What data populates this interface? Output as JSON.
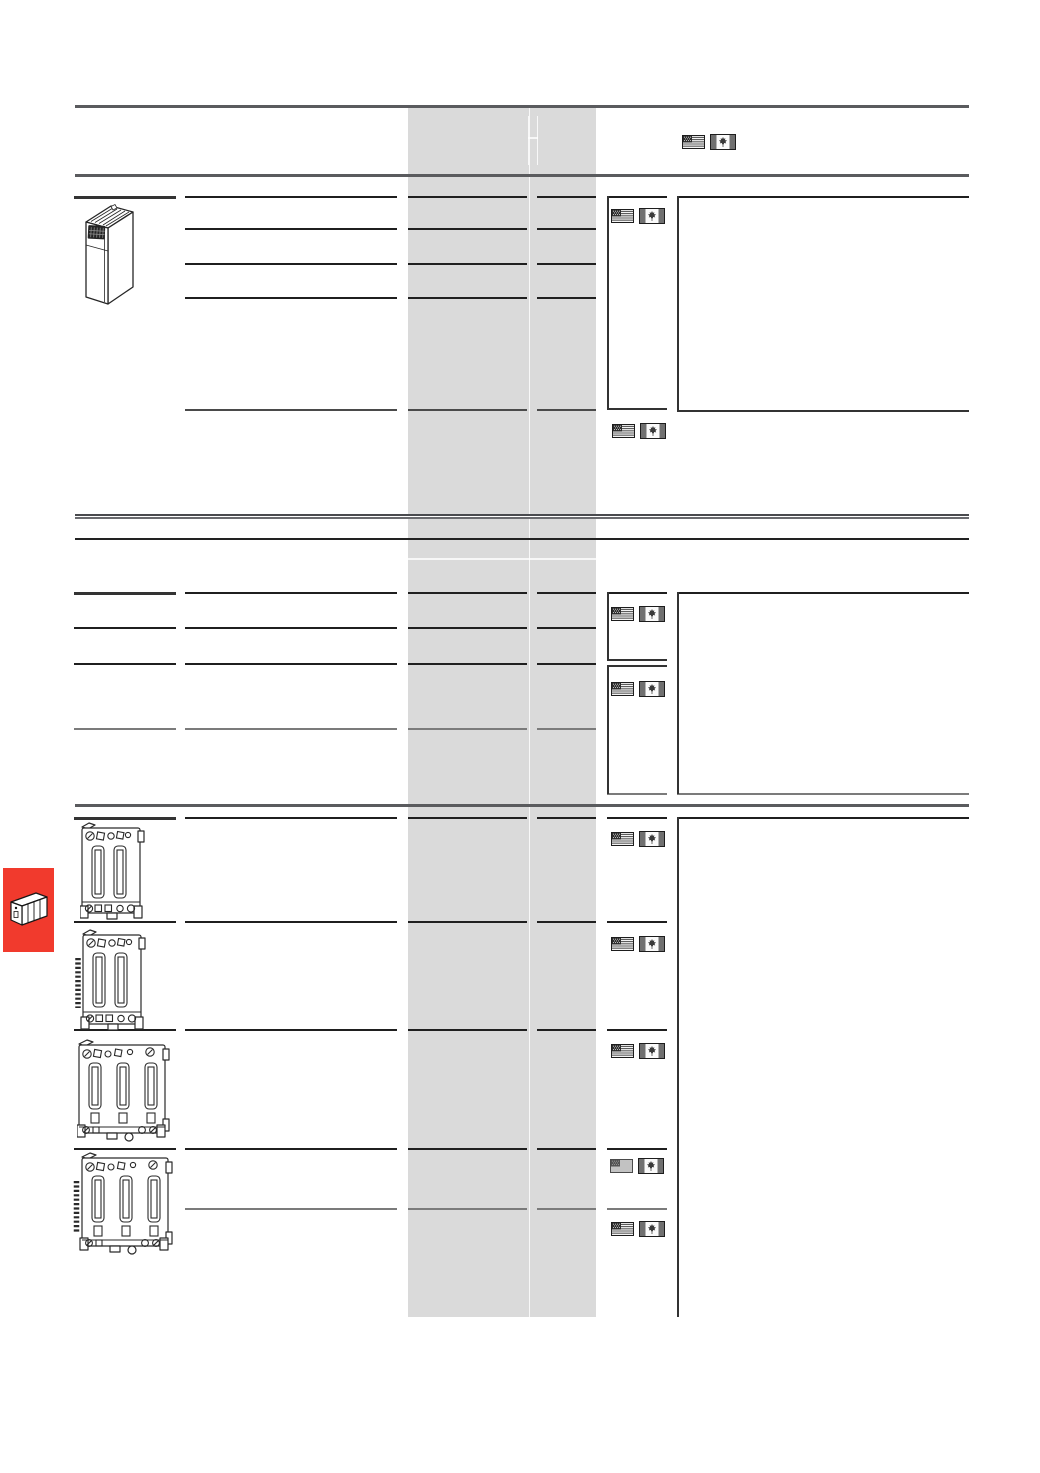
{
  "page": {
    "width": 1040,
    "height": 1473,
    "background": "#ffffff",
    "kind": "catalog-price-list-template",
    "visible_text": ""
  },
  "colors": {
    "price_band": "#dadada",
    "section_rule": "#5a5b5e",
    "row_line": "#1f1f1f",
    "subrow_line": "#7b7b7b",
    "sidebar_tab_red": "#f13a2d",
    "flag_canton": "#2c2c2c",
    "flag_stripe": "#5c5c5c",
    "flag_bar": "#707070"
  },
  "icons": {
    "us_flag": "united-states-flag",
    "canada_flag": "canada-flag",
    "us_flag_faded": "united-states-flag-grayed",
    "plc_rack": "plc-rack-pictogram",
    "plc_module": "plc-module-line-drawing",
    "terminal_block_2": "terminal-block-2-connectors",
    "terminal_block_2_pins": "terminal-block-2-connectors-with-pin-strip",
    "terminal_block_3": "terminal-block-3-connectors",
    "terminal_block_3_pins": "terminal-block-3-connectors-with-pin-strip"
  },
  "header": {
    "flag_pair": [
      "us_flag",
      "canada_flag"
    ]
  },
  "price_column": {
    "sub_columns": 2,
    "shaded": true
  },
  "sections": [
    {
      "id": 1,
      "row_lines": 4,
      "sub_row_lines": 1,
      "flag_pairs": [
        {
          "flags": [
            "us_flag",
            "canada_flag"
          ]
        },
        {
          "flags": [
            "us_flag",
            "canada_flag"
          ]
        }
      ],
      "products": [
        "plc_module"
      ]
    },
    {
      "id": 2,
      "row_lines": 4,
      "sub_row_lines": 1,
      "flag_pairs": [
        {
          "flags": [
            "us_flag",
            "canada_flag"
          ]
        },
        {
          "flags": [
            "us_flag",
            "canada_flag"
          ]
        }
      ],
      "products": []
    },
    {
      "id": 3,
      "row_lines": 5,
      "sub_row_lines": 1,
      "flag_pairs": [
        {
          "flags": [
            "us_flag",
            "canada_flag"
          ]
        },
        {
          "flags": [
            "us_flag",
            "canada_flag"
          ]
        },
        {
          "flags": [
            "us_flag",
            "canada_flag"
          ]
        },
        {
          "flags": [
            "us_flag_faded",
            "canada_flag"
          ]
        },
        {
          "flags": [
            "us_flag",
            "canada_flag"
          ]
        }
      ],
      "products": [
        "terminal_block_2",
        "terminal_block_2_pins",
        "terminal_block_3",
        "terminal_block_3_pins"
      ]
    }
  ],
  "sidebar_tab": {
    "color": "#f13a2d",
    "icon": "plc_rack"
  }
}
